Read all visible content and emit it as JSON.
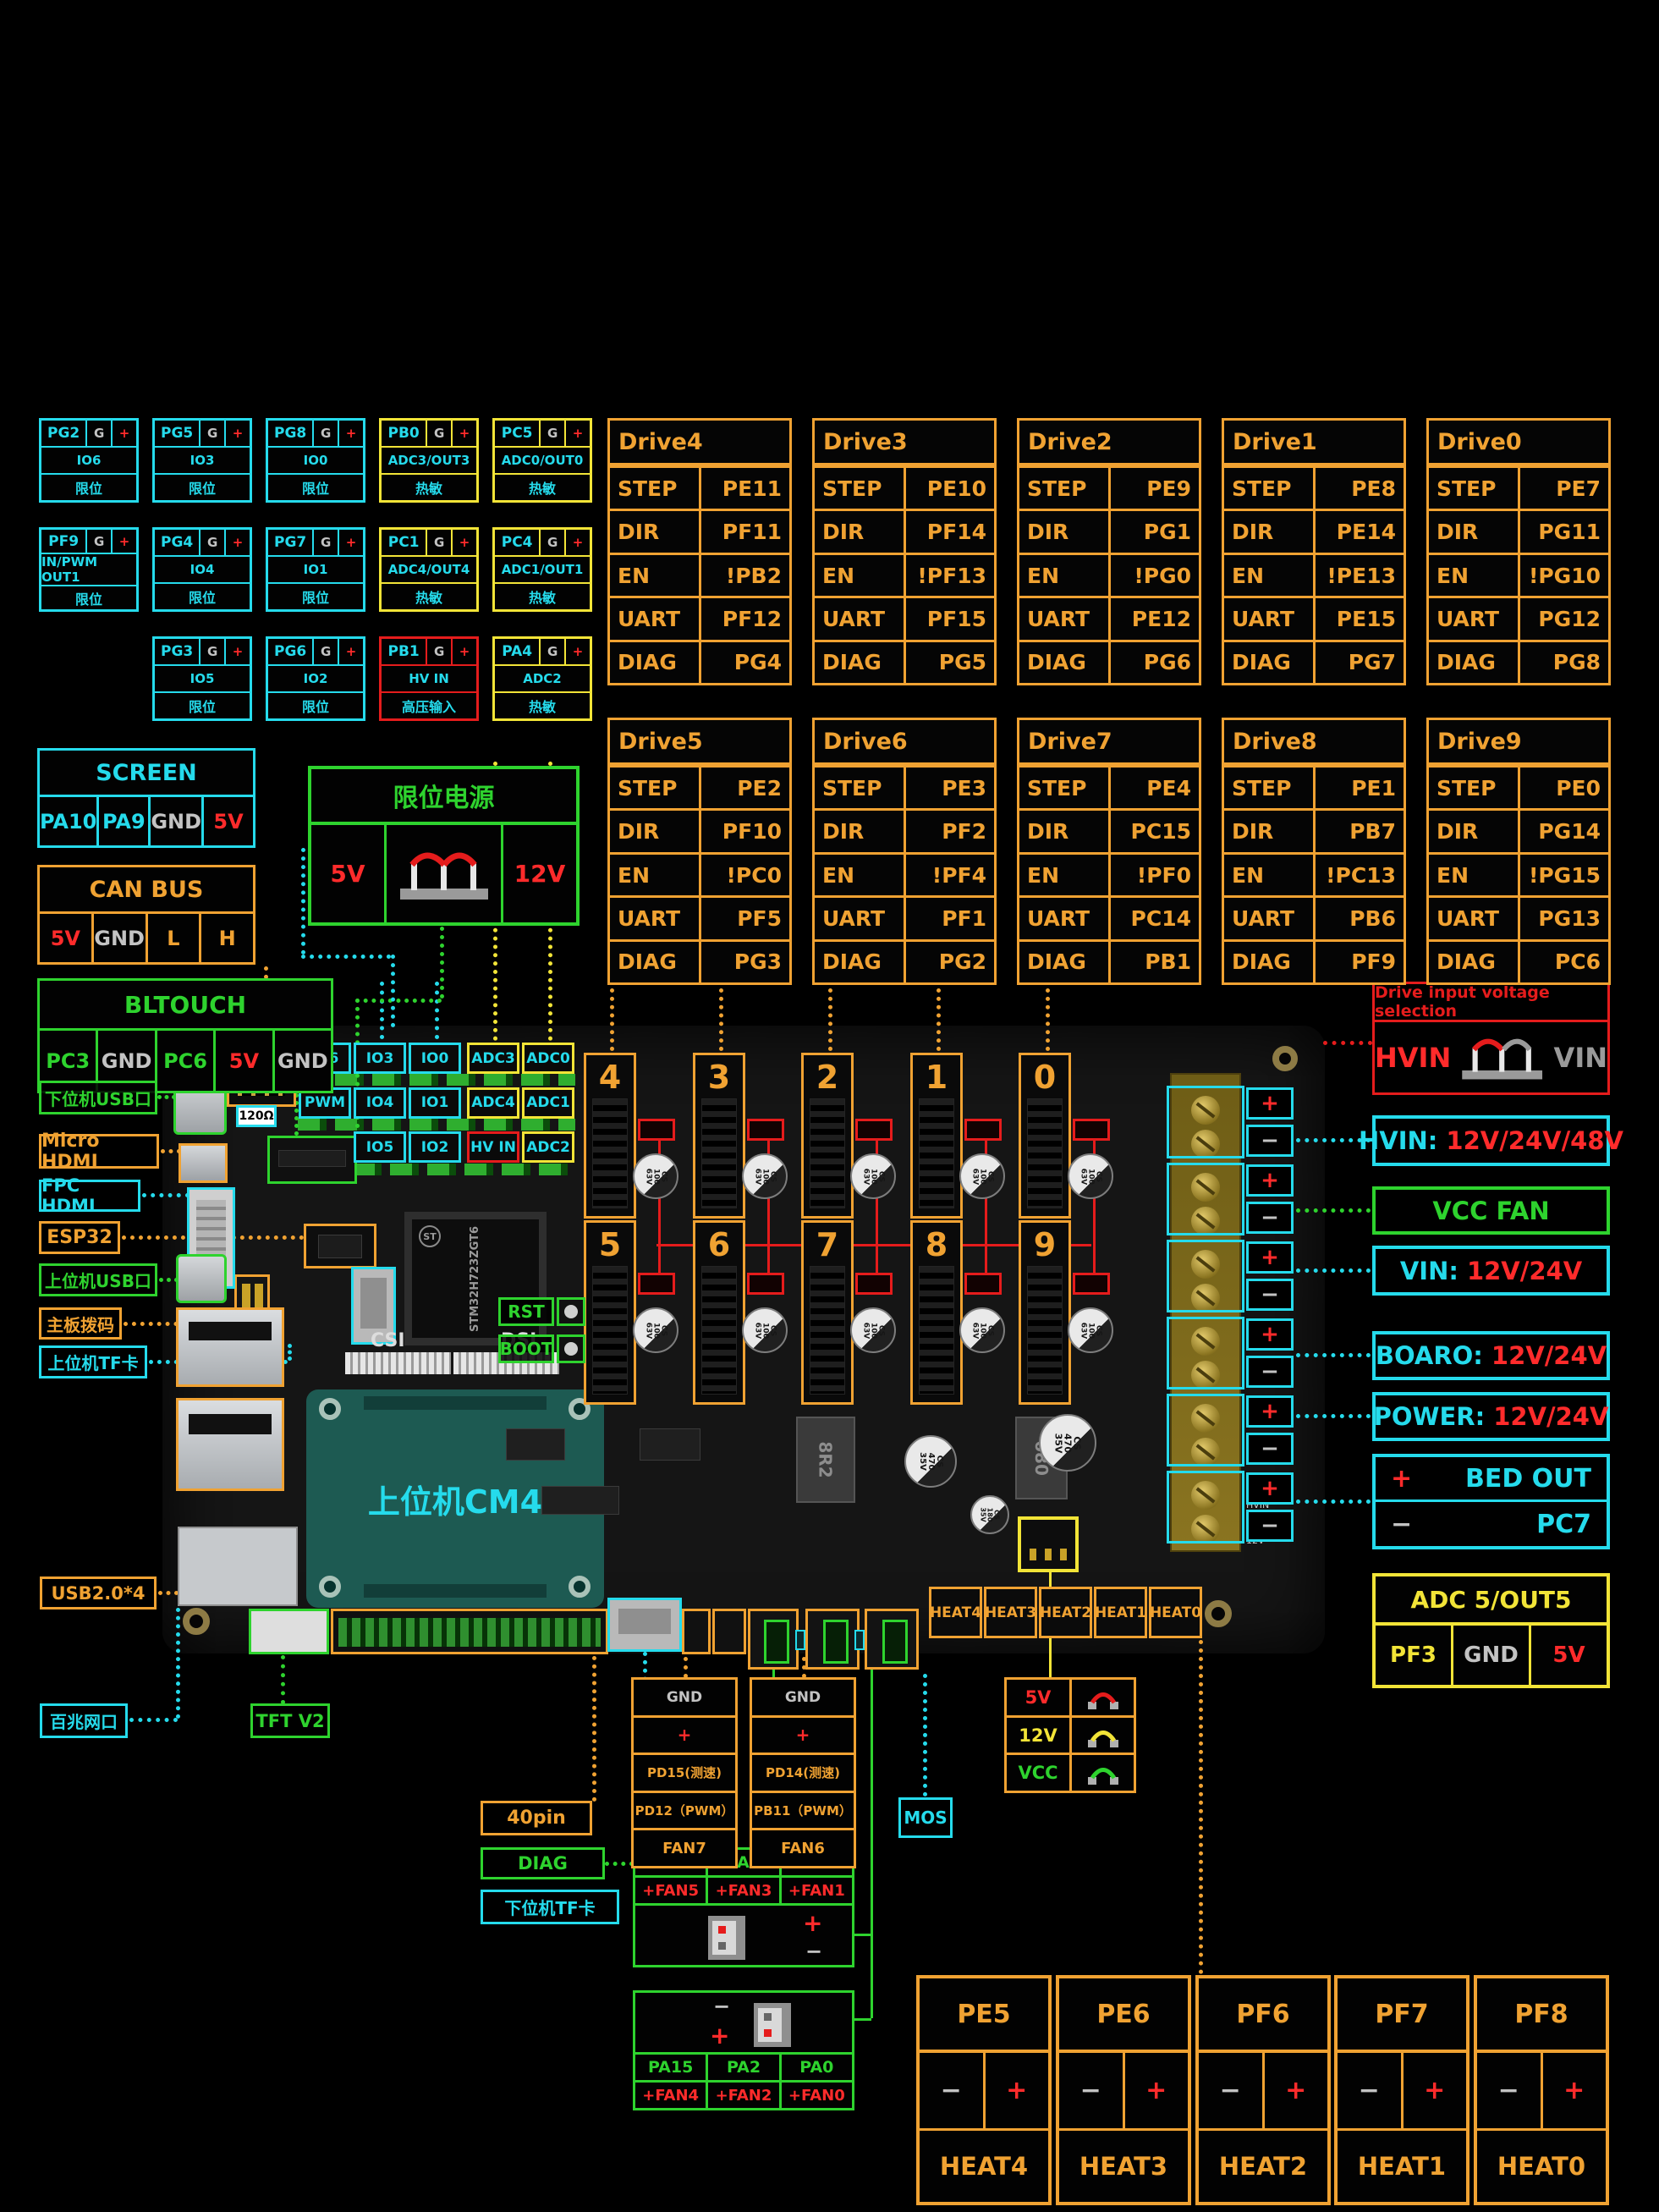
{
  "io_grid": {
    "g_label": "G",
    "plus_label": "+",
    "cells": [
      {
        "pin": "PG2",
        "mid": "IO6",
        "bot": "限位",
        "type": "cyan",
        "row": 0,
        "col": 0
      },
      {
        "pin": "PG5",
        "mid": "IO3",
        "bot": "限位",
        "type": "cyan",
        "row": 0,
        "col": 1
      },
      {
        "pin": "PG8",
        "mid": "IO0",
        "bot": "限位",
        "type": "cyan",
        "row": 0,
        "col": 2
      },
      {
        "pin": "PB0",
        "mid": "ADC3/OUT3",
        "bot": "热敏",
        "type": "yellow",
        "row": 0,
        "col": 3
      },
      {
        "pin": "PC5",
        "mid": "ADC0/OUT0",
        "bot": "热敏",
        "type": "yellow",
        "row": 0,
        "col": 4
      },
      {
        "pin": "PF9",
        "mid": "IN/PWM OUT1",
        "bot": "限位",
        "type": "cyan",
        "row": 1,
        "col": 0
      },
      {
        "pin": "PG4",
        "mid": "IO4",
        "bot": "限位",
        "type": "cyan",
        "row": 1,
        "col": 1
      },
      {
        "pin": "PG7",
        "mid": "IO1",
        "bot": "限位",
        "type": "cyan",
        "row": 1,
        "col": 2
      },
      {
        "pin": "PC1",
        "mid": "ADC4/OUT4",
        "bot": "热敏",
        "type": "yellow",
        "row": 1,
        "col": 3
      },
      {
        "pin": "PC4",
        "mid": "ADC1/OUT1",
        "bot": "热敏",
        "type": "yellow",
        "row": 1,
        "col": 4
      },
      {
        "pin": "PG3",
        "mid": "IO5",
        "bot": "限位",
        "type": "cyan",
        "row": 2,
        "col": 1
      },
      {
        "pin": "PG6",
        "mid": "IO2",
        "bot": "限位",
        "type": "cyan",
        "row": 2,
        "col": 2
      },
      {
        "pin": "PB1",
        "mid": "HV IN",
        "bot": "高压输入",
        "type": "red",
        "row": 2,
        "col": 3
      },
      {
        "pin": "PA4",
        "mid": "ADC2",
        "bot": "热敏",
        "type": "yellow",
        "row": 2,
        "col": 4
      }
    ]
  },
  "drive_row_labels": [
    "STEP",
    "DIR",
    "EN",
    "UART",
    "DIAG"
  ],
  "drives": [
    {
      "name": "Drive4",
      "step": "PE11",
      "dir": "PF11",
      "en": "!PB2",
      "uart": "PF12",
      "diag": "PG4"
    },
    {
      "name": "Drive3",
      "step": "PE10",
      "dir": "PF14",
      "en": "!PF13",
      "uart": "PF15",
      "diag": "PG5"
    },
    {
      "name": "Drive2",
      "step": "PE9",
      "dir": "PG1",
      "en": "!PG0",
      "uart": "PE12",
      "diag": "PG6"
    },
    {
      "name": "Drive1",
      "step": "PE8",
      "dir": "PE14",
      "en": "!PE13",
      "uart": "PE15",
      "diag": "PG7"
    },
    {
      "name": "Drive0",
      "step": "PE7",
      "dir": "PG11",
      "en": "!PG10",
      "uart": "PG12",
      "diag": "PG8"
    },
    {
      "name": "Drive5",
      "step": "PE2",
      "dir": "PF10",
      "en": "!PC0",
      "uart": "PF5",
      "diag": "PG3"
    },
    {
      "name": "Drive6",
      "step": "PE3",
      "dir": "PF2",
      "en": "!PF4",
      "uart": "PF1",
      "diag": "PG2"
    },
    {
      "name": "Drive7",
      "step": "PE4",
      "dir": "PC15",
      "en": "!PF0",
      "uart": "PC14",
      "diag": "PB1"
    },
    {
      "name": "Drive8",
      "step": "PE1",
      "dir": "PB7",
      "en": "!PC13",
      "uart": "PB6",
      "diag": "PF9"
    },
    {
      "name": "Drive9",
      "step": "PE0",
      "dir": "PG14",
      "en": "!PG15",
      "uart": "PG13",
      "diag": "PC6"
    }
  ],
  "screen": {
    "title": "SCREEN",
    "pins": [
      {
        "t": "PA10"
      },
      {
        "t": "PA9"
      },
      {
        "t": "GND"
      },
      {
        "t": "5V"
      }
    ]
  },
  "canbus": {
    "title": "CAN BUS",
    "pins": [
      {
        "t": "5V"
      },
      {
        "t": "GND"
      },
      {
        "t": "L"
      },
      {
        "t": "H"
      }
    ]
  },
  "bltouch": {
    "title": "BLTOUCH",
    "pins": [
      {
        "t": "PC3"
      },
      {
        "t": "GND"
      },
      {
        "t": "PC6"
      },
      {
        "t": "5V"
      },
      {
        "t": "GND"
      }
    ]
  },
  "limit_power": {
    "title": "限位电源",
    "left": "5V",
    "right": "12V"
  },
  "callouts": [
    {
      "text": "下位机USB口",
      "color": "green"
    },
    {
      "text": "Micro HDMI",
      "color": "orange"
    },
    {
      "text": "FPC HDMI",
      "color": "cyan"
    },
    {
      "text": "ESP32",
      "color": "orange"
    },
    {
      "text": "上位机USB口",
      "color": "green"
    },
    {
      "text": "主板拨码",
      "color": "orange"
    },
    {
      "text": "上位机TF卡",
      "color": "cyan"
    },
    {
      "text": "USB2.0*4",
      "color": "orange"
    },
    {
      "text": "百兆网口",
      "color": "cyan"
    },
    {
      "text": "TFT V2",
      "color": "green"
    },
    {
      "text": "40pin",
      "color": "orange"
    },
    {
      "text": "DIAG",
      "color": "green"
    },
    {
      "text": "下位机TF卡",
      "color": "cyan"
    }
  ],
  "right_panel": {
    "dvs_title": "Drive input voltage selection",
    "hvin_label": "HVIN",
    "vin_label": "VIN",
    "rows": [
      {
        "prefix": "HVIN:",
        "value": "12V/24V/48V"
      },
      {
        "text": "VCC FAN"
      },
      {
        "prefix": "VIN:",
        "value": "12V/24V"
      },
      {
        "prefix": "BOARO:",
        "value": "12V/24V"
      },
      {
        "prefix": "POWER:",
        "value": "12V/24V"
      }
    ],
    "bed": {
      "plus": "+",
      "label": "BED OUT",
      "minus": "−",
      "pin": "PC7"
    },
    "adc": {
      "title": "ADC 5/OUT5",
      "pins": [
        {
          "t": "PF3"
        },
        {
          "t": "GND"
        },
        {
          "t": "5V"
        }
      ]
    }
  },
  "board": {
    "cm4": "上位机CM4",
    "chip": "STM32H723ZGT6",
    "st": "ST",
    "rst": "RST",
    "boot": "BOOT",
    "csi": "CSI",
    "dsi": "DSI",
    "res": "120Ω",
    "socket_numbers": [
      "4",
      "3",
      "2",
      "1",
      "0",
      "5",
      "6",
      "7",
      "8",
      "9"
    ],
    "cap_small": "CS\n100\n63V",
    "cap_big": "CS\n470\n35V",
    "cap_mid": "CS\n180\n35V",
    "ind1": "8R2",
    "ind2": "680",
    "conn_labels": [
      {
        "t": "IO6",
        "b": "cyan",
        "row": 0,
        "col": 0
      },
      {
        "t": "IO3",
        "b": "cyan",
        "row": 0,
        "col": 1
      },
      {
        "t": "IO0",
        "b": "cyan",
        "row": 0,
        "col": 2
      },
      {
        "t": "ADC3",
        "b": "yellow",
        "row": 0,
        "col": 3
      },
      {
        "t": "ADC0",
        "b": "yellow",
        "row": 0,
        "col": 4
      },
      {
        "t": "PWM",
        "b": "cyan",
        "row": 1,
        "col": 0
      },
      {
        "t": "IO4",
        "b": "cyan",
        "row": 1,
        "col": 1
      },
      {
        "t": "IO1",
        "b": "cyan",
        "row": 1,
        "col": 2
      },
      {
        "t": "ADC4",
        "b": "yellow",
        "row": 1,
        "col": 3
      },
      {
        "t": "ADC1",
        "b": "yellow",
        "row": 1,
        "col": 4
      },
      {
        "t": "IO5",
        "b": "cyan",
        "row": 2,
        "col": 1
      },
      {
        "t": "IO2",
        "b": "cyan",
        "row": 2,
        "col": 2
      },
      {
        "t": "HV IN",
        "b": "red",
        "row": 2,
        "col": 3
      },
      {
        "t": "ADC2",
        "b": "yellow",
        "row": 2,
        "col": 4
      }
    ],
    "silkscreen": [
      "HVIN",
      "VIN",
      "BED",
      "12V"
    ]
  },
  "heat_row": [
    "HEAT4",
    "HEAT3",
    "HEAT2",
    "HEAT1",
    "HEAT0"
  ],
  "fan7": {
    "rows": [
      {
        "t": "GND",
        "c": "gray"
      },
      {
        "t": "+",
        "c": "red2"
      },
      {
        "t": "PD15(测速)",
        "c": "orange"
      },
      {
        "t": "PD12（PWM）",
        "c": "orange"
      },
      {
        "t": "FAN7",
        "c": "orange"
      }
    ]
  },
  "fan6": {
    "rows": [
      {
        "t": "GND",
        "c": "gray"
      },
      {
        "t": "+",
        "c": "red2"
      },
      {
        "t": "PD14(测速)",
        "c": "orange"
      },
      {
        "t": "PB11（PWM）",
        "c": "orange"
      },
      {
        "t": "FAN6",
        "c": "orange"
      }
    ]
  },
  "mos_label": "MOS",
  "vsel": {
    "rows": [
      {
        "t": "5V",
        "c": "red2"
      },
      {
        "t": "12V",
        "c": "yellow"
      },
      {
        "t": "VCC",
        "c": "green"
      }
    ]
  },
  "fan_top": {
    "headers": [
      "PB10",
      "PA3",
      "PA1"
    ],
    "fans": [
      "+FAN5",
      "+FAN3",
      "+FAN1"
    ],
    "plus": "+",
    "minus": "−"
  },
  "fan_bottom": {
    "headers": [
      "PA15",
      "PA2",
      "PA0"
    ],
    "fans": [
      "+FAN4",
      "+FAN2",
      "+FAN0"
    ],
    "plus": "+",
    "minus": "−"
  },
  "heaters": [
    {
      "pin": "PE5",
      "minus": "−",
      "plus": "+",
      "heat": "HEAT4"
    },
    {
      "pin": "PE6",
      "minus": "−",
      "plus": "+",
      "heat": "HEAT3"
    },
    {
      "pin": "PF6",
      "minus": "−",
      "plus": "+",
      "heat": "HEAT2"
    },
    {
      "pin": "PF7",
      "minus": "−",
      "plus": "+",
      "heat": "HEAT1"
    },
    {
      "pin": "PF8",
      "minus": "−",
      "plus": "+",
      "heat": "HEAT0"
    }
  ],
  "terminal": {
    "plus": "+",
    "minus": "−"
  }
}
